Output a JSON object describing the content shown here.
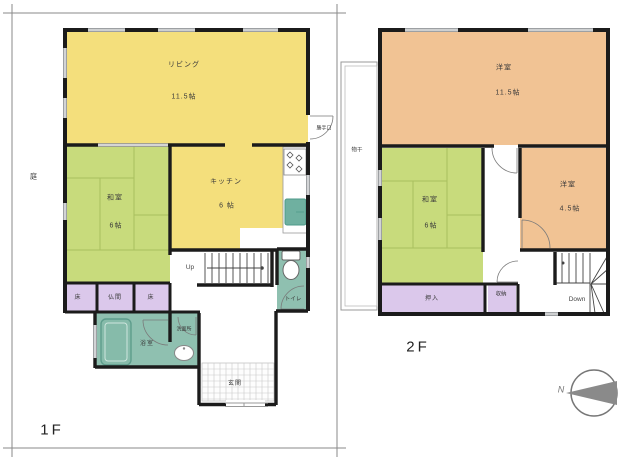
{
  "colors": {
    "room-yellow": "#F4DF7C",
    "room-green": "#C8DB7C",
    "room-orange": "#F1C394",
    "room-purple": "#DBC8EB",
    "room-teal": "#8FC0B0",
    "fixture-teal": "#6FB0A0",
    "wall": "#1b1b1b",
    "line-gray": "#999999"
  },
  "floor1": {
    "label": "1F",
    "garden": "庭",
    "stairs": "Up",
    "back_door": "勝手口",
    "rooms": {
      "living": {
        "name": "リビング",
        "size": "11.5帖"
      },
      "kitchen": {
        "name": "キッチン",
        "size": "6 帖"
      },
      "washitsu": {
        "name": "和室",
        "size": "6帖"
      },
      "toko_left": "床",
      "butsuma": "仏間",
      "toko_right": "床",
      "bath": "浴室",
      "washroom": "洗面所",
      "toilet": "トイレ",
      "genkan": "玄関"
    }
  },
  "floor2": {
    "label": "2F",
    "stairs": "Down",
    "drying": "物干",
    "rooms": {
      "western_large": {
        "name": "洋室",
        "size": "11.5帖"
      },
      "washitsu": {
        "name": "和室",
        "size": "6帖"
      },
      "western_small": {
        "name": "洋室",
        "size": "4.5帖"
      },
      "oshiire": "押入",
      "storage": "収納"
    }
  },
  "compass": {
    "north": "N"
  }
}
